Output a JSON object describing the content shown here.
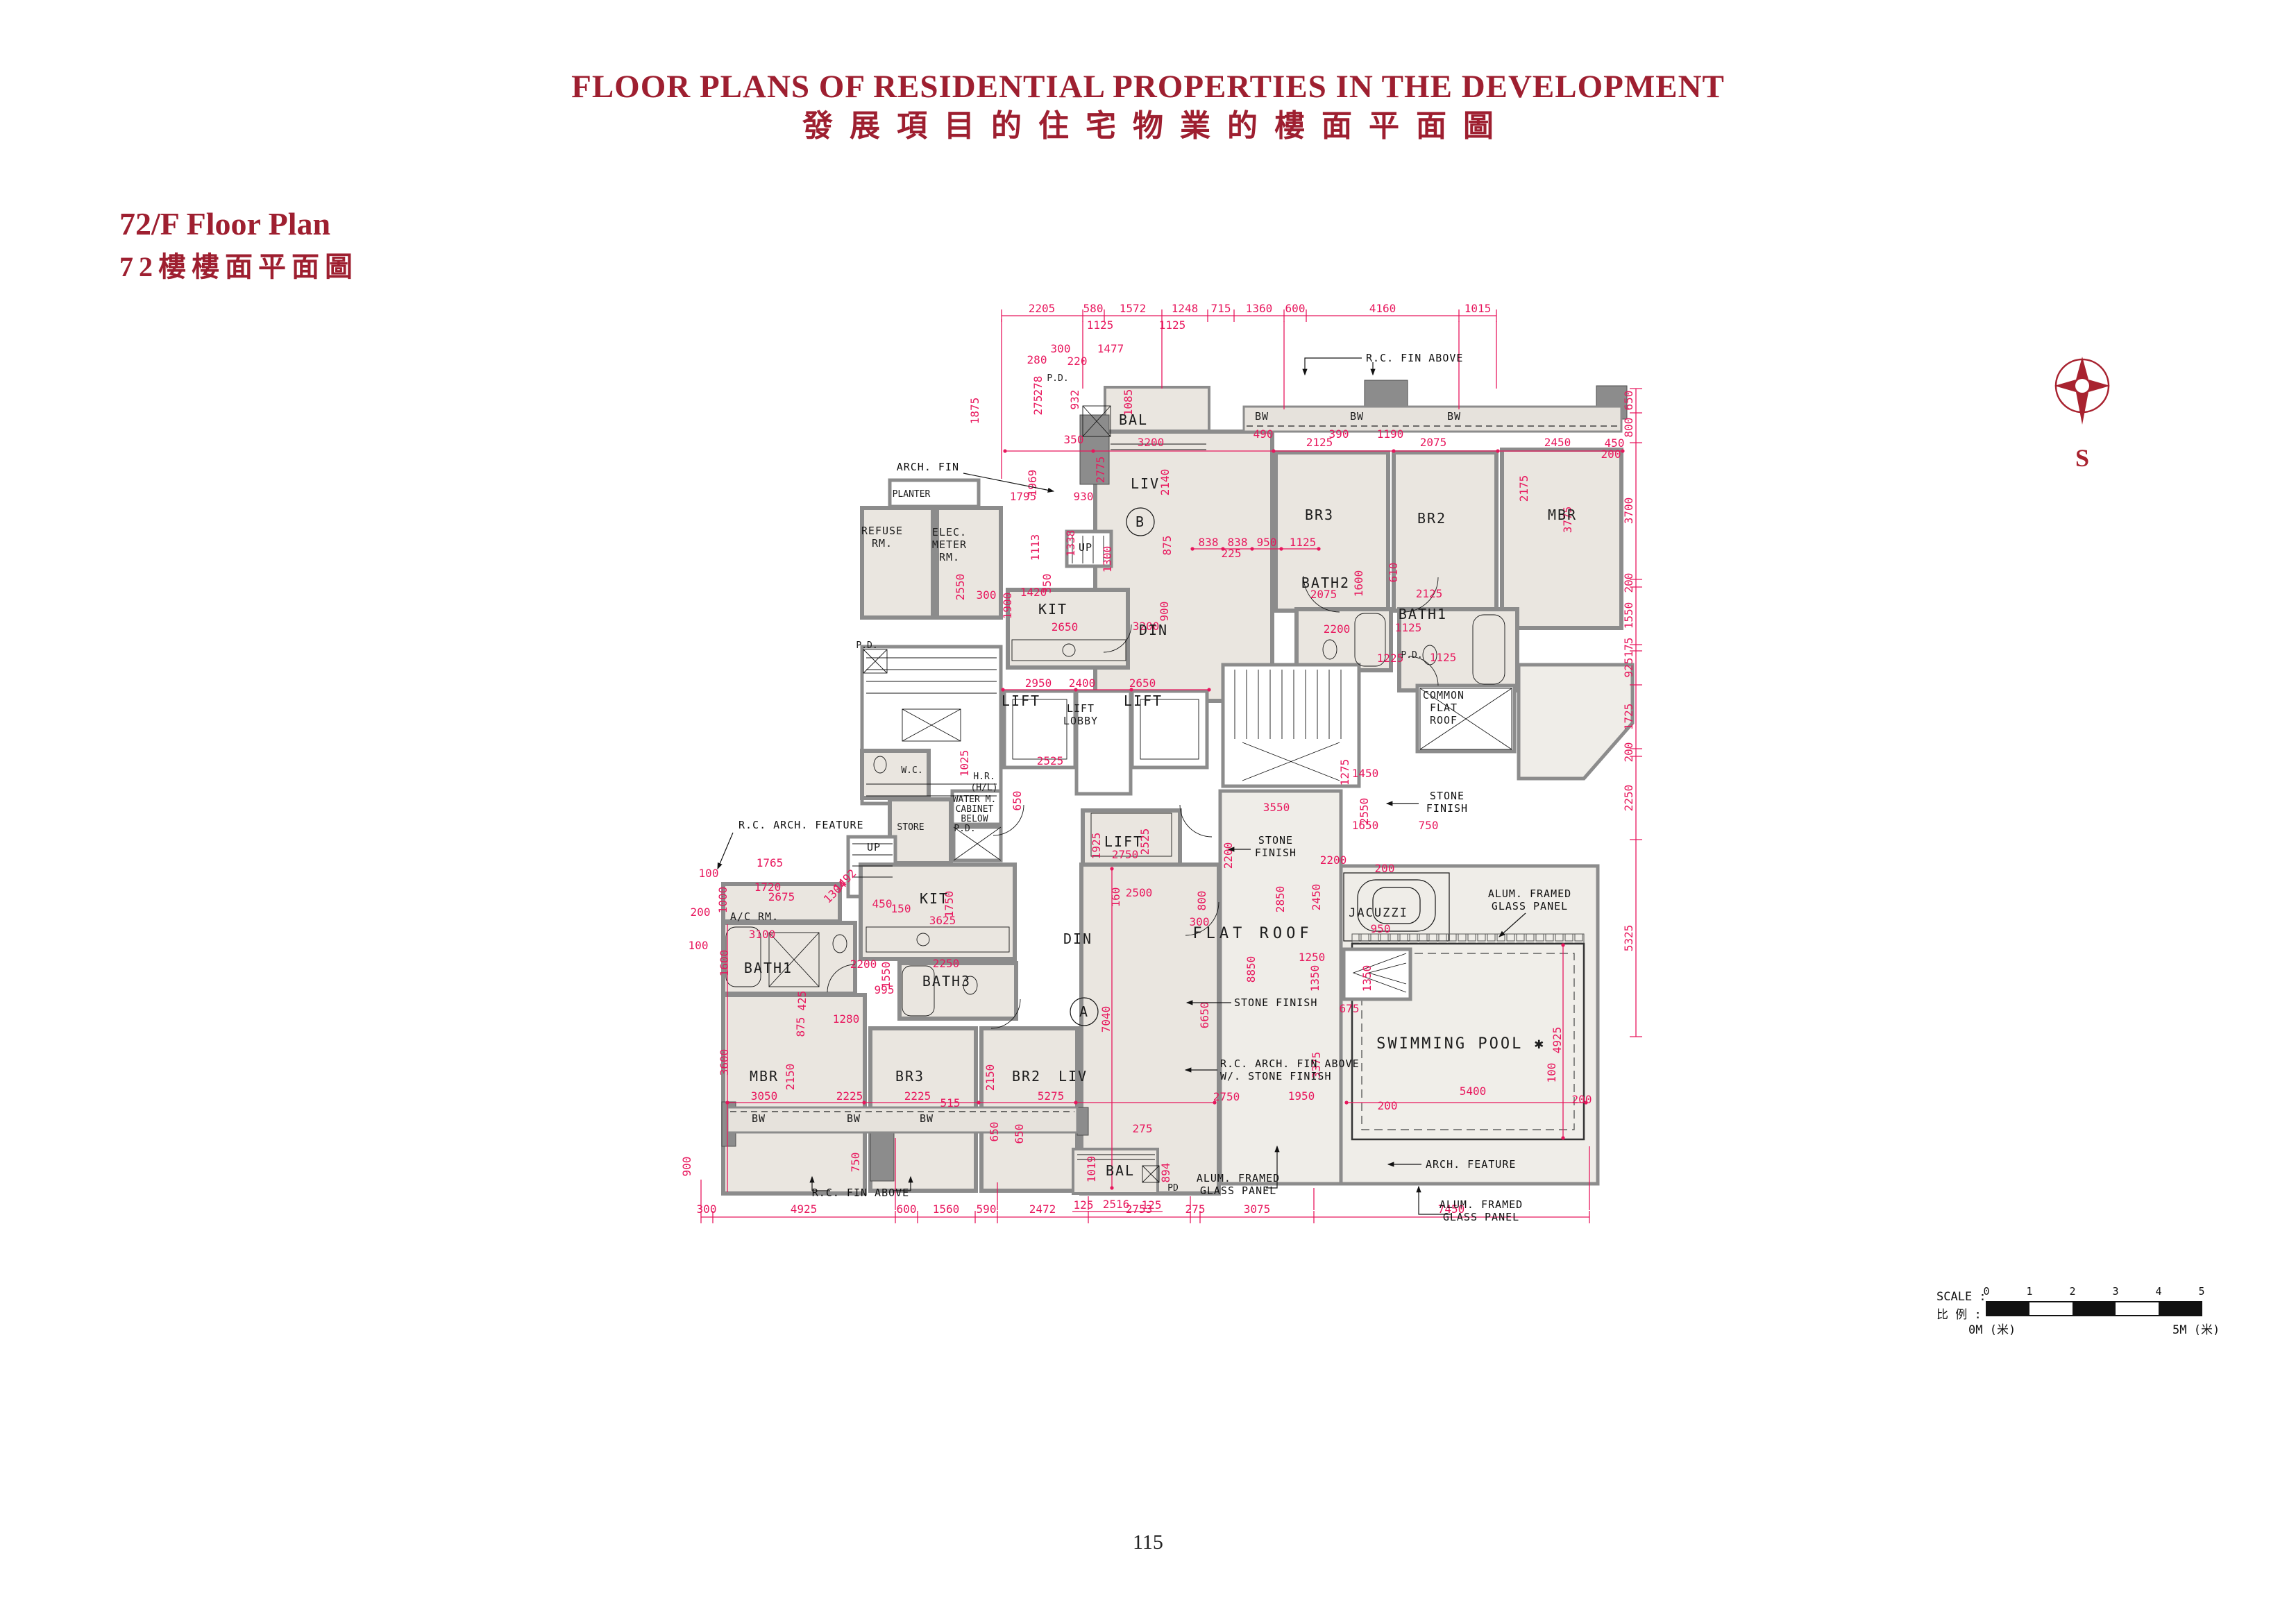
{
  "header": {
    "title_en": "FLOOR PLANS OF RESIDENTIAL PROPERTIES IN THE DEVELOPMENT",
    "title_zh": "發展項目的住宅物業的樓面平面圖",
    "floor_en": "72/F Floor Plan",
    "floor_zh": "72樓樓面平面圖"
  },
  "footer": {
    "page_number": "115"
  },
  "compass": {
    "label": "S"
  },
  "scale_bar": {
    "label_en": "SCALE :",
    "label_zh": "比 例 :",
    "ticks": [
      "0",
      "1",
      "2",
      "3",
      "4",
      "5"
    ],
    "start_label": "0M (米)",
    "end_label": "5M (米)"
  },
  "plan": {
    "labels": {
      "bal": "BAL",
      "liv": "LIV",
      "din": "DIN",
      "kit": "KIT",
      "up": "UP",
      "pd": "P.D.",
      "pd_short": "PD",
      "br2": "BR2",
      "br3": "BR3",
      "mbr": "MBR",
      "bath1": "BATH1",
      "bath2": "BATH2",
      "bath3": "BATH3",
      "wc": "W.C.",
      "store": "STORE",
      "planter": "PLANTER",
      "refuse_1": "REFUSE",
      "refuse_2": "RM.",
      "elec_1": "ELEC.",
      "elec_2": "METER",
      "elec_3": "RM.",
      "lift": "LIFT",
      "lobby_1": "LIFT",
      "lobby_2": "LOBBY",
      "common_1": "COMMON",
      "common_2": "FLAT",
      "common_3": "ROOF",
      "water_1": "WATER M.",
      "water_2": "CABINET",
      "water_3": "BELOW",
      "hr_1": "H.R.",
      "hr_2": "(H/L)",
      "ac": "A/C RM.",
      "flat_roof": "FLAT ROOF",
      "jacuzzi": "JACUZZI",
      "pool": "SWIMMING POOL ✱",
      "bw": "BW",
      "unit_a": "A",
      "unit_b": "B",
      "lift_a_dim": "2750"
    },
    "annotations": {
      "rc_fin_above": "R.C. FIN ABOVE",
      "arch_fin": "ARCH. FIN",
      "rc_arch_feature": "R.C. ARCH. FEATURE",
      "stone_1": "STONE",
      "stone_2": "FINISH",
      "stone_finish": "STONE FINISH",
      "rc_arch_fin_1": "R.C. ARCH. FIN ABOVE",
      "rc_arch_fin_2": "W/. STONE FINISH",
      "alum_1": "ALUM. FRAMED",
      "alum_2": "GLASS PANEL",
      "arch_feature": "ARCH. FEATURE"
    },
    "dims": {
      "top": [
        "2205",
        "580",
        "1572",
        "1248",
        "715",
        "1360",
        "600",
        "4160",
        "1015"
      ],
      "top_sub": [
        "1125",
        "1125"
      ],
      "bottom": [
        "300",
        "4925",
        "600",
        "1560",
        "590",
        "2472",
        "2753",
        "275",
        "3075",
        "7450"
      ],
      "right": [
        "650",
        "800",
        "3700",
        "200",
        "1550",
        "175",
        "925",
        "1725",
        "200",
        "2250",
        "5325"
      ],
      "misc": [
        "300",
        "1477",
        "280",
        "220",
        "278",
        "275",
        "1875",
        "932",
        "1085",
        "350",
        "3200",
        "490",
        "2125",
        "390",
        "1190",
        "2075",
        "2450",
        "450",
        "200",
        "2775",
        "2140",
        "2175",
        "3775",
        "1795",
        "930",
        "1969",
        "1113",
        "1338",
        "838",
        "838",
        "950",
        "1125",
        "225",
        "1300",
        "875",
        "900",
        "2550",
        "1420",
        "300",
        "1900",
        "350",
        "2650",
        "3200",
        "2075",
        "1600",
        "610",
        "2125",
        "1125",
        "2200",
        "2950",
        "2400",
        "2650",
        "1225",
        "1125",
        "1025",
        "2525",
        "650",
        "3550",
        "1275",
        "1450",
        "2550",
        "1650",
        "750",
        "2200",
        "1925",
        "2525",
        "2750",
        "2500",
        "160",
        "800",
        "300",
        "2200",
        "200",
        "2850",
        "2450",
        "950",
        "1250",
        "1350",
        "1350",
        "675",
        "3375",
        "8850",
        "6650",
        "7040",
        "4925",
        "5400",
        "5275",
        "2750",
        "1950",
        "1765",
        "1720",
        "2675",
        "100",
        "1000",
        "200",
        "1492",
        "1304",
        "3100",
        "1600",
        "100",
        "2200",
        "1550",
        "2250",
        "995",
        "1280",
        "425",
        "875",
        "3600",
        "450",
        "150",
        "3625",
        "1750",
        "2150",
        "2150",
        "3050",
        "2225",
        "2225",
        "515",
        "650",
        "900",
        "750",
        "125",
        "2516",
        "125",
        "1019",
        "650",
        "894",
        "275",
        "200",
        "200",
        "100"
      ]
    },
    "colors": {
      "accent": "#E8175D",
      "title": "#9E1F30",
      "wall": "#8C8C8C",
      "room_fill": "#EAE6E0"
    }
  }
}
